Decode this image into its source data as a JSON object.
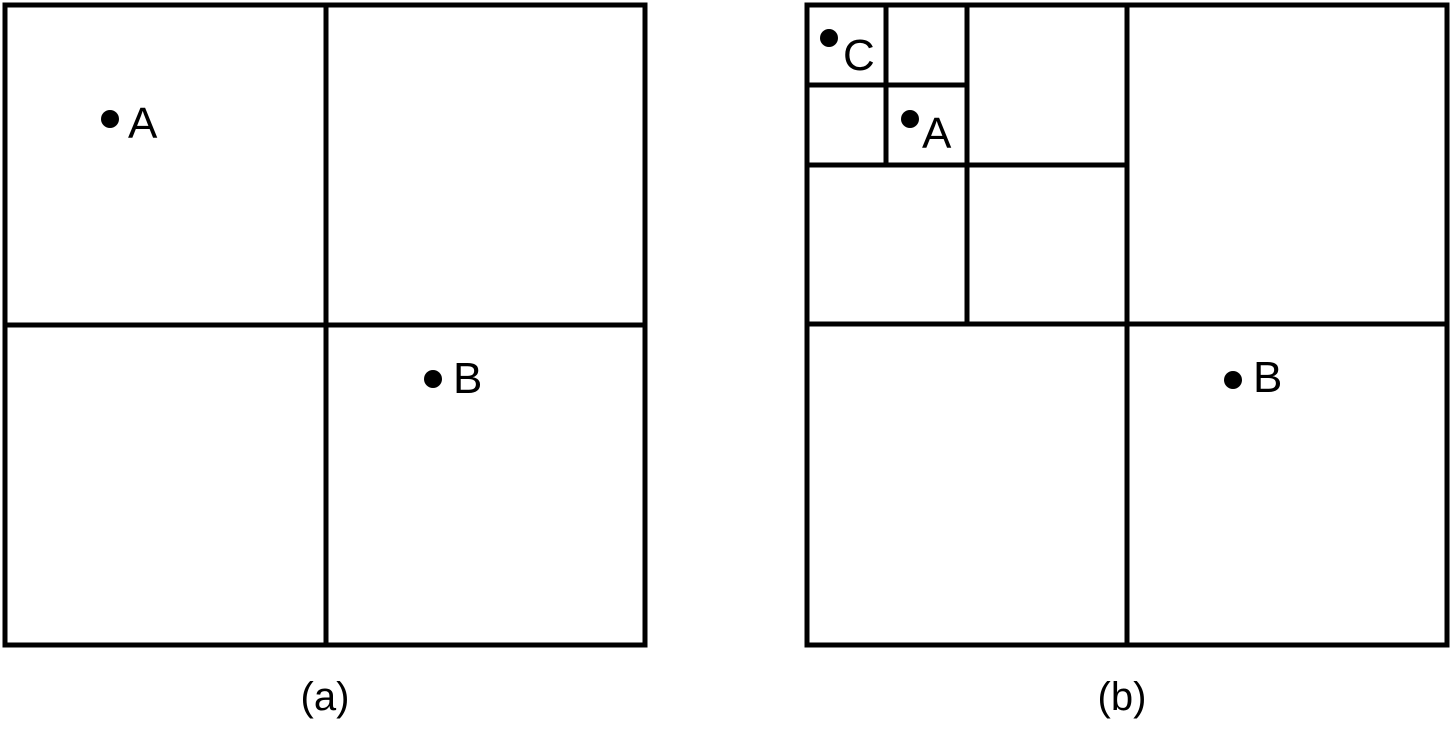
{
  "figure": {
    "description": "Quadtree subdivision diagram with two panels",
    "colors": {
      "background": "#ffffff",
      "line": "#000000",
      "point": "#000000",
      "text": "#000000"
    },
    "stroke_width": 5,
    "point_radius": 9,
    "panels": [
      {
        "id": "a",
        "caption": "(a)",
        "caption_center": {
          "x": 325,
          "y": 710
        },
        "frame": {
          "x": 5,
          "y": 5,
          "w": 640,
          "h": 640
        },
        "subdivision_lines": [
          {
            "x1": 326,
            "y1": 5,
            "x2": 326,
            "y2": 645
          },
          {
            "x1": 5,
            "y1": 325,
            "x2": 645,
            "y2": 325
          }
        ],
        "points": [
          {
            "label": "A",
            "x": 110,
            "y": 119,
            "label_x": 128,
            "label_y": 138
          },
          {
            "label": "B",
            "x": 433,
            "y": 379,
            "label_x": 453,
            "label_y": 393
          }
        ]
      },
      {
        "id": "b",
        "caption": "(b)",
        "caption_center": {
          "x": 1122,
          "y": 710
        },
        "frame": {
          "x": 807,
          "y": 5,
          "w": 640,
          "h": 640
        },
        "subdivision_lines": [
          {
            "x1": 1127,
            "y1": 5,
            "x2": 1127,
            "y2": 645
          },
          {
            "x1": 807,
            "y1": 324,
            "x2": 1447,
            "y2": 324
          },
          {
            "x1": 967,
            "y1": 5,
            "x2": 967,
            "y2": 324
          },
          {
            "x1": 807,
            "y1": 165,
            "x2": 1127,
            "y2": 165
          },
          {
            "x1": 886,
            "y1": 5,
            "x2": 886,
            "y2": 165
          },
          {
            "x1": 807,
            "y1": 85,
            "x2": 967,
            "y2": 85
          }
        ],
        "points": [
          {
            "label": "C",
            "x": 829,
            "y": 38,
            "label_x": 843,
            "label_y": 70
          },
          {
            "label": "A",
            "x": 910,
            "y": 119,
            "label_x": 922,
            "label_y": 148
          },
          {
            "label": "B",
            "x": 1233,
            "y": 380,
            "label_x": 1253,
            "label_y": 392
          }
        ]
      }
    ]
  }
}
